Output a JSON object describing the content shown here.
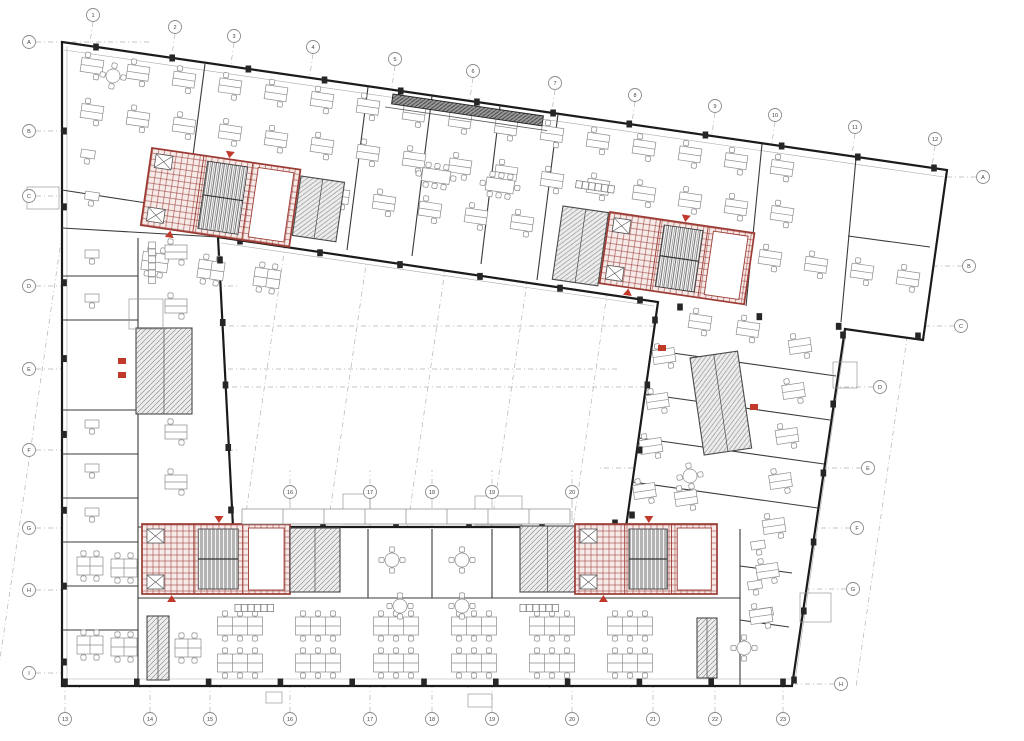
{
  "title": "Office building floor plan — furniture layout with highlighted stair/elevator cores",
  "palette": {
    "wall": "#1b1b1b",
    "partition": "#3a3a3a",
    "furniture": "#8b8b8b",
    "core_red": "#9c3b34",
    "core_red_bright": "#c0392b",
    "core_red_fill": "#f6ebe9",
    "core_gray": "#4a4a4a",
    "grid": "#9a9a9a",
    "bubble_stroke": "#8a8a8a",
    "bubble_text": "#444444",
    "column": "#262626",
    "thin": "#aaaaaa"
  },
  "canvas": {
    "w": 1024,
    "h": 741
  },
  "outline": {
    "outer": [
      [
        62,
        42
      ],
      [
        947,
        170
      ],
      [
        923,
        340
      ],
      [
        845,
        329
      ],
      [
        792,
        686
      ],
      [
        62,
        686
      ]
    ],
    "courtyard": [
      [
        218,
        237
      ],
      [
        658,
        302
      ],
      [
        626,
        527
      ],
      [
        233,
        527
      ]
    ]
  },
  "thin_lines": [
    [
      64,
      50,
      944,
      177
    ],
    [
      64,
      679,
      791,
      679
    ],
    [
      846,
      333,
      795,
      681
    ],
    [
      221,
      243,
      654,
      306
    ],
    [
      67,
      46,
      67,
      684
    ]
  ],
  "walls": [
    [
      205,
      64,
      184,
      224
    ],
    [
      62,
      190,
      205,
      212
    ],
    [
      368,
      87,
      347,
      250
    ],
    [
      432,
      96,
      412,
      256
    ],
    [
      500,
      106,
      481,
      264
    ],
    [
      558,
      114,
      537,
      280
    ],
    [
      762,
      144,
      746,
      306
    ],
    [
      856,
      158,
      841,
      322
    ],
    [
      848,
      236,
      930,
      247
    ],
    [
      62,
      228,
      218,
      237
    ],
    [
      62,
      276,
      138,
      276
    ],
    [
      62,
      320,
      138,
      320
    ],
    [
      62,
      410,
      138,
      410
    ],
    [
      62,
      454,
      138,
      454
    ],
    [
      62,
      498,
      138,
      498
    ],
    [
      62,
      542,
      138,
      542
    ],
    [
      62,
      586,
      138,
      586
    ],
    [
      62,
      630,
      138,
      630
    ],
    [
      138,
      238,
      138,
      686
    ],
    [
      138,
      527,
      233,
      527
    ],
    [
      368,
      529,
      368,
      598
    ],
    [
      432,
      529,
      432,
      598
    ],
    [
      492,
      529,
      492,
      598
    ],
    [
      138,
      598,
      740,
      598
    ],
    [
      740,
      529,
      740,
      686
    ],
    [
      740,
      566,
      792,
      573
    ],
    [
      740,
      620,
      789,
      627
    ],
    [
      651,
      350,
      836,
      376
    ],
    [
      645,
      394,
      830,
      420
    ],
    [
      639,
      438,
      824,
      464
    ],
    [
      633,
      482,
      818,
      508
    ]
  ],
  "canopy": {
    "x": 393,
    "y": 94,
    "w": 152,
    "h": 10,
    "r": 8.3
  },
  "cores": [
    {
      "name": "stair-core-northwest",
      "x": 152,
      "y": 148,
      "w": 150,
      "h": 78,
      "r": 8.3,
      "k": "red"
    },
    {
      "name": "service-core-northwest",
      "x": 301,
      "y": 176,
      "w": 44,
      "h": 60,
      "r": 8.3,
      "k": "gray"
    },
    {
      "name": "service-core-northeast",
      "x": 563,
      "y": 206,
      "w": 46,
      "h": 74,
      "r": 8.3,
      "k": "gray"
    },
    {
      "name": "stair-core-northeast",
      "x": 610,
      "y": 212,
      "w": 146,
      "h": 72,
      "r": 8.3,
      "k": "red"
    },
    {
      "name": "stair-core-southwest",
      "x": 142,
      "y": 524,
      "w": 148,
      "h": 70,
      "r": 0,
      "k": "red"
    },
    {
      "name": "service-core-southwest",
      "x": 290,
      "y": 528,
      "w": 50,
      "h": 64,
      "r": 0,
      "k": "gray"
    },
    {
      "name": "service-core-south",
      "x": 520,
      "y": 526,
      "w": 55,
      "h": 66,
      "r": 0,
      "k": "gray"
    },
    {
      "name": "stair-core-south",
      "x": 575,
      "y": 524,
      "w": 142,
      "h": 70,
      "r": 0,
      "k": "red"
    },
    {
      "name": "wc-core-west",
      "x": 136,
      "y": 328,
      "w": 56,
      "h": 86,
      "r": 0,
      "k": "gray"
    },
    {
      "name": "wc-core-east",
      "x": 690,
      "y": 358,
      "w": 48,
      "h": 98,
      "r": -8.3,
      "k": "gray"
    },
    {
      "name": "stair-shaft-southwest",
      "x": 147,
      "y": 616,
      "w": 22,
      "h": 64,
      "r": 0,
      "k": "gray"
    },
    {
      "name": "stair-shaft-southeast",
      "x": 697,
      "y": 618,
      "w": 20,
      "h": 60,
      "r": 0,
      "k": "gray"
    }
  ],
  "furniture": [
    {
      "t": "desks2",
      "x": 92,
      "y": 66,
      "dx": 46,
      "dy": 6.8,
      "n": 16,
      "r": 8.3
    },
    {
      "t": "desks2",
      "x": 92,
      "y": 112,
      "dx": 46,
      "dy": 6.8,
      "n": 16,
      "r": 8.3
    },
    {
      "t": "desks2",
      "x": 338,
      "y": 196,
      "dx": 46,
      "dy": 6.8,
      "n": 5,
      "r": 8.3
    },
    {
      "t": "desks2",
      "x": 770,
      "y": 258,
      "dx": 46,
      "dy": 6.8,
      "n": 4,
      "r": 8.3
    },
    {
      "t": "desks4",
      "x": 155,
      "y": 262,
      "dx": 56,
      "dy": 8,
      "n": 3,
      "r": 8.3
    },
    {
      "t": "meet8",
      "x": 436,
      "y": 176,
      "dx": 64,
      "dy": 9.4,
      "n": 2,
      "r": 8.3
    },
    {
      "t": "meet4",
      "x": 113,
      "y": 76,
      "dx": 0,
      "dy": 0,
      "n": 1,
      "r": 8.3
    },
    {
      "t": "lockers",
      "x": 576,
      "y": 184,
      "dx": 0,
      "dy": 0,
      "n": 5,
      "r": 8.3
    },
    {
      "t": "desk1",
      "x": 88,
      "y": 154,
      "dx": 4,
      "dy": 42,
      "n": 2,
      "r": 8.3
    },
    {
      "t": "desk1",
      "x": 92,
      "y": 254,
      "dx": 0,
      "dy": 44,
      "n": 2,
      "r": 0
    },
    {
      "t": "desk1",
      "x": 92,
      "y": 424,
      "dx": 0,
      "dy": 44,
      "n": 3,
      "r": 0
    },
    {
      "t": "desks2",
      "x": 176,
      "y": 252,
      "dx": 0,
      "dy": 54,
      "n": 2,
      "r": 0
    },
    {
      "t": "desks2",
      "x": 176,
      "y": 432,
      "dx": 0,
      "dy": 50,
      "n": 2,
      "r": 0
    },
    {
      "t": "lockersV",
      "x": 152,
      "y": 242,
      "dx": 0,
      "dy": 0,
      "n": 6,
      "r": 0
    },
    {
      "t": "desks4",
      "x": 90,
      "y": 566,
      "dx": 34,
      "dy": 2,
      "n": 2,
      "r": 0
    },
    {
      "t": "desks4",
      "x": 90,
      "y": 645,
      "dx": 34,
      "dy": 2,
      "n": 2,
      "r": 0
    },
    {
      "t": "desks4",
      "x": 188,
      "y": 648,
      "dx": 0,
      "dy": 0,
      "n": 1,
      "r": 0
    },
    {
      "t": "desk1",
      "x": 200,
      "y": 560,
      "dx": 0,
      "dy": 0,
      "n": 1,
      "r": 0
    },
    {
      "t": "bench6",
      "x": 240,
      "y": 626,
      "dx": 78,
      "dy": 0,
      "n": 6,
      "r": 0
    },
    {
      "t": "bench6",
      "x": 240,
      "y": 663,
      "dx": 78,
      "dy": 0,
      "n": 6,
      "r": 0
    },
    {
      "t": "meet4",
      "x": 322,
      "y": 560,
      "dx": 70,
      "dy": 0,
      "n": 3,
      "r": 0
    },
    {
      "t": "meet4",
      "x": 400,
      "y": 606,
      "dx": 62,
      "dy": 0,
      "n": 2,
      "r": 0
    },
    {
      "t": "lockers",
      "x": 235,
      "y": 608,
      "dx": 0,
      "dy": 0,
      "n": 8,
      "r": 0
    },
    {
      "t": "lockers",
      "x": 520,
      "y": 608,
      "dx": 0,
      "dy": 0,
      "n": 6,
      "r": 0
    },
    {
      "t": "desk1",
      "x": 758,
      "y": 545,
      "dx": -3,
      "dy": 40,
      "n": 2,
      "r": -8.3
    },
    {
      "t": "meet4",
      "x": 744,
      "y": 648,
      "dx": 0,
      "dy": 0,
      "n": 1,
      "r": 0
    },
    {
      "t": "desk1",
      "x": 766,
      "y": 612,
      "dx": 0,
      "dy": 0,
      "n": 1,
      "r": -8.3
    },
    {
      "t": "desks2",
      "x": 800,
      "y": 346,
      "dx": -6.5,
      "dy": 45,
      "n": 7,
      "r": -8.3
    },
    {
      "t": "desks2",
      "x": 664,
      "y": 356,
      "dx": -6.5,
      "dy": 45,
      "n": 4,
      "r": -8.3
    },
    {
      "t": "desks2",
      "x": 686,
      "y": 498,
      "dx": -6,
      "dy": 42,
      "n": 2,
      "r": -8.3
    },
    {
      "t": "desks2",
      "x": 700,
      "y": 322,
      "dx": 48,
      "dy": 7,
      "n": 2,
      "r": 8.3
    },
    {
      "t": "meet4",
      "x": 690,
      "y": 476,
      "dx": 0,
      "dy": 0,
      "n": 1,
      "r": -8.3
    }
  ],
  "red_bits": [
    [
      118,
      358
    ],
    [
      118,
      372
    ],
    [
      750,
      404
    ],
    [
      658,
      345
    ]
  ],
  "tag_boxes": [
    [
      27,
      187,
      32,
      22
    ],
    [
      129,
      299,
      34,
      30
    ],
    [
      343,
      494,
      27,
      30
    ],
    [
      475,
      496,
      47,
      29
    ],
    [
      800,
      593,
      31,
      29
    ],
    [
      266,
      692,
      16,
      11
    ],
    [
      468,
      694,
      24,
      13
    ],
    [
      833,
      362,
      24,
      26
    ]
  ],
  "dim_strip": {
    "x": 242,
    "y": 509,
    "w": 328,
    "h": 15,
    "ticks": 8
  },
  "column_edges": [
    {
      "p1": [
        96,
        47
      ],
      "p2": [
        934,
        168
      ],
      "n": 12
    },
    {
      "p1": [
        65,
        682
      ],
      "p2": [
        783,
        682
      ],
      "n": 11
    },
    {
      "p1": [
        240,
        241
      ],
      "p2": [
        640,
        300
      ],
      "n": 6
    },
    {
      "p1": [
        250,
        523
      ],
      "p2": [
        615,
        523
      ],
      "n": 6
    },
    {
      "p1": [
        64,
        131
      ],
      "p2": [
        64,
        662
      ],
      "n": 8
    },
    {
      "p1": [
        843,
        335
      ],
      "p2": [
        794,
        680
      ],
      "n": 6
    },
    {
      "p1": [
        220,
        260
      ],
      "p2": [
        231,
        510
      ],
      "n": 5
    },
    {
      "p1": [
        655,
        320
      ],
      "p2": [
        632,
        515
      ],
      "n": 4
    },
    {
      "p1": [
        680,
        307
      ],
      "p2": [
        918,
        336
      ],
      "n": 4
    }
  ],
  "bubbles": {
    "top": [
      {
        "x": 93,
        "y": 15,
        "l": "1"
      },
      {
        "x": 175,
        "y": 27,
        "l": "2"
      },
      {
        "x": 234,
        "y": 36,
        "l": "3"
      },
      {
        "x": 313,
        "y": 47,
        "l": "4"
      },
      {
        "x": 395,
        "y": 59,
        "l": "5"
      },
      {
        "x": 473,
        "y": 71,
        "l": "6"
      },
      {
        "x": 555,
        "y": 83,
        "l": "7"
      },
      {
        "x": 635,
        "y": 95,
        "l": "8"
      },
      {
        "x": 715,
        "y": 106,
        "l": "9"
      },
      {
        "x": 775,
        "y": 115,
        "l": "10"
      },
      {
        "x": 855,
        "y": 127,
        "l": "11"
      },
      {
        "x": 935,
        "y": 139,
        "l": "12"
      }
    ],
    "bottom": [
      {
        "x": 65,
        "y": 719,
        "l": "13"
      },
      {
        "x": 150,
        "y": 719,
        "l": "14"
      },
      {
        "x": 210,
        "y": 719,
        "l": "15"
      },
      {
        "x": 290,
        "y": 719,
        "l": "16"
      },
      {
        "x": 370,
        "y": 719,
        "l": "17"
      },
      {
        "x": 432,
        "y": 719,
        "l": "18"
      },
      {
        "x": 492,
        "y": 719,
        "l": "19"
      },
      {
        "x": 572,
        "y": 719,
        "l": "20"
      },
      {
        "x": 653,
        "y": 719,
        "l": "21"
      },
      {
        "x": 715,
        "y": 719,
        "l": "22"
      },
      {
        "x": 783,
        "y": 719,
        "l": "23"
      }
    ],
    "left": [
      {
        "x": 29,
        "y": 42,
        "l": "A",
        "ex": 150
      },
      {
        "x": 29,
        "y": 131,
        "l": "B",
        "ex": 238
      },
      {
        "x": 29,
        "y": 196,
        "l": "C",
        "ex": 238
      },
      {
        "x": 29,
        "y": 286,
        "l": "D",
        "ex": 238
      },
      {
        "x": 29,
        "y": 369,
        "l": "E",
        "ex": 620
      },
      {
        "x": 29,
        "y": 450,
        "l": "F",
        "ex": 238
      },
      {
        "x": 29,
        "y": 528,
        "l": "G",
        "ex": 238
      },
      {
        "x": 29,
        "y": 590,
        "l": "H",
        "ex": 238
      },
      {
        "x": 29,
        "y": 673,
        "l": "I",
        "ex": 238
      }
    ],
    "right": [
      {
        "x": 983,
        "y": 177,
        "l": "A",
        "ex": 938
      },
      {
        "x": 969,
        "y": 266,
        "l": "B",
        "ex": 920
      },
      {
        "x": 961,
        "y": 326,
        "l": "C",
        "ex": 220
      },
      {
        "x": 880,
        "y": 387,
        "l": "D",
        "ex": 80
      },
      {
        "x": 868,
        "y": 468,
        "l": "E",
        "ex": 600
      },
      {
        "x": 857,
        "y": 528,
        "l": "F",
        "ex": 745
      },
      {
        "x": 853,
        "y": 589,
        "l": "G",
        "ex": 755
      },
      {
        "x": 841,
        "y": 684,
        "l": "H",
        "ex": 795
      }
    ],
    "inner": [
      {
        "x": 290,
        "y": 492,
        "l": "16"
      },
      {
        "x": 370,
        "y": 492,
        "l": "17"
      },
      {
        "x": 432,
        "y": 492,
        "l": "18"
      },
      {
        "x": 492,
        "y": 492,
        "l": "19"
      },
      {
        "x": 572,
        "y": 492,
        "l": "20"
      }
    ]
  }
}
